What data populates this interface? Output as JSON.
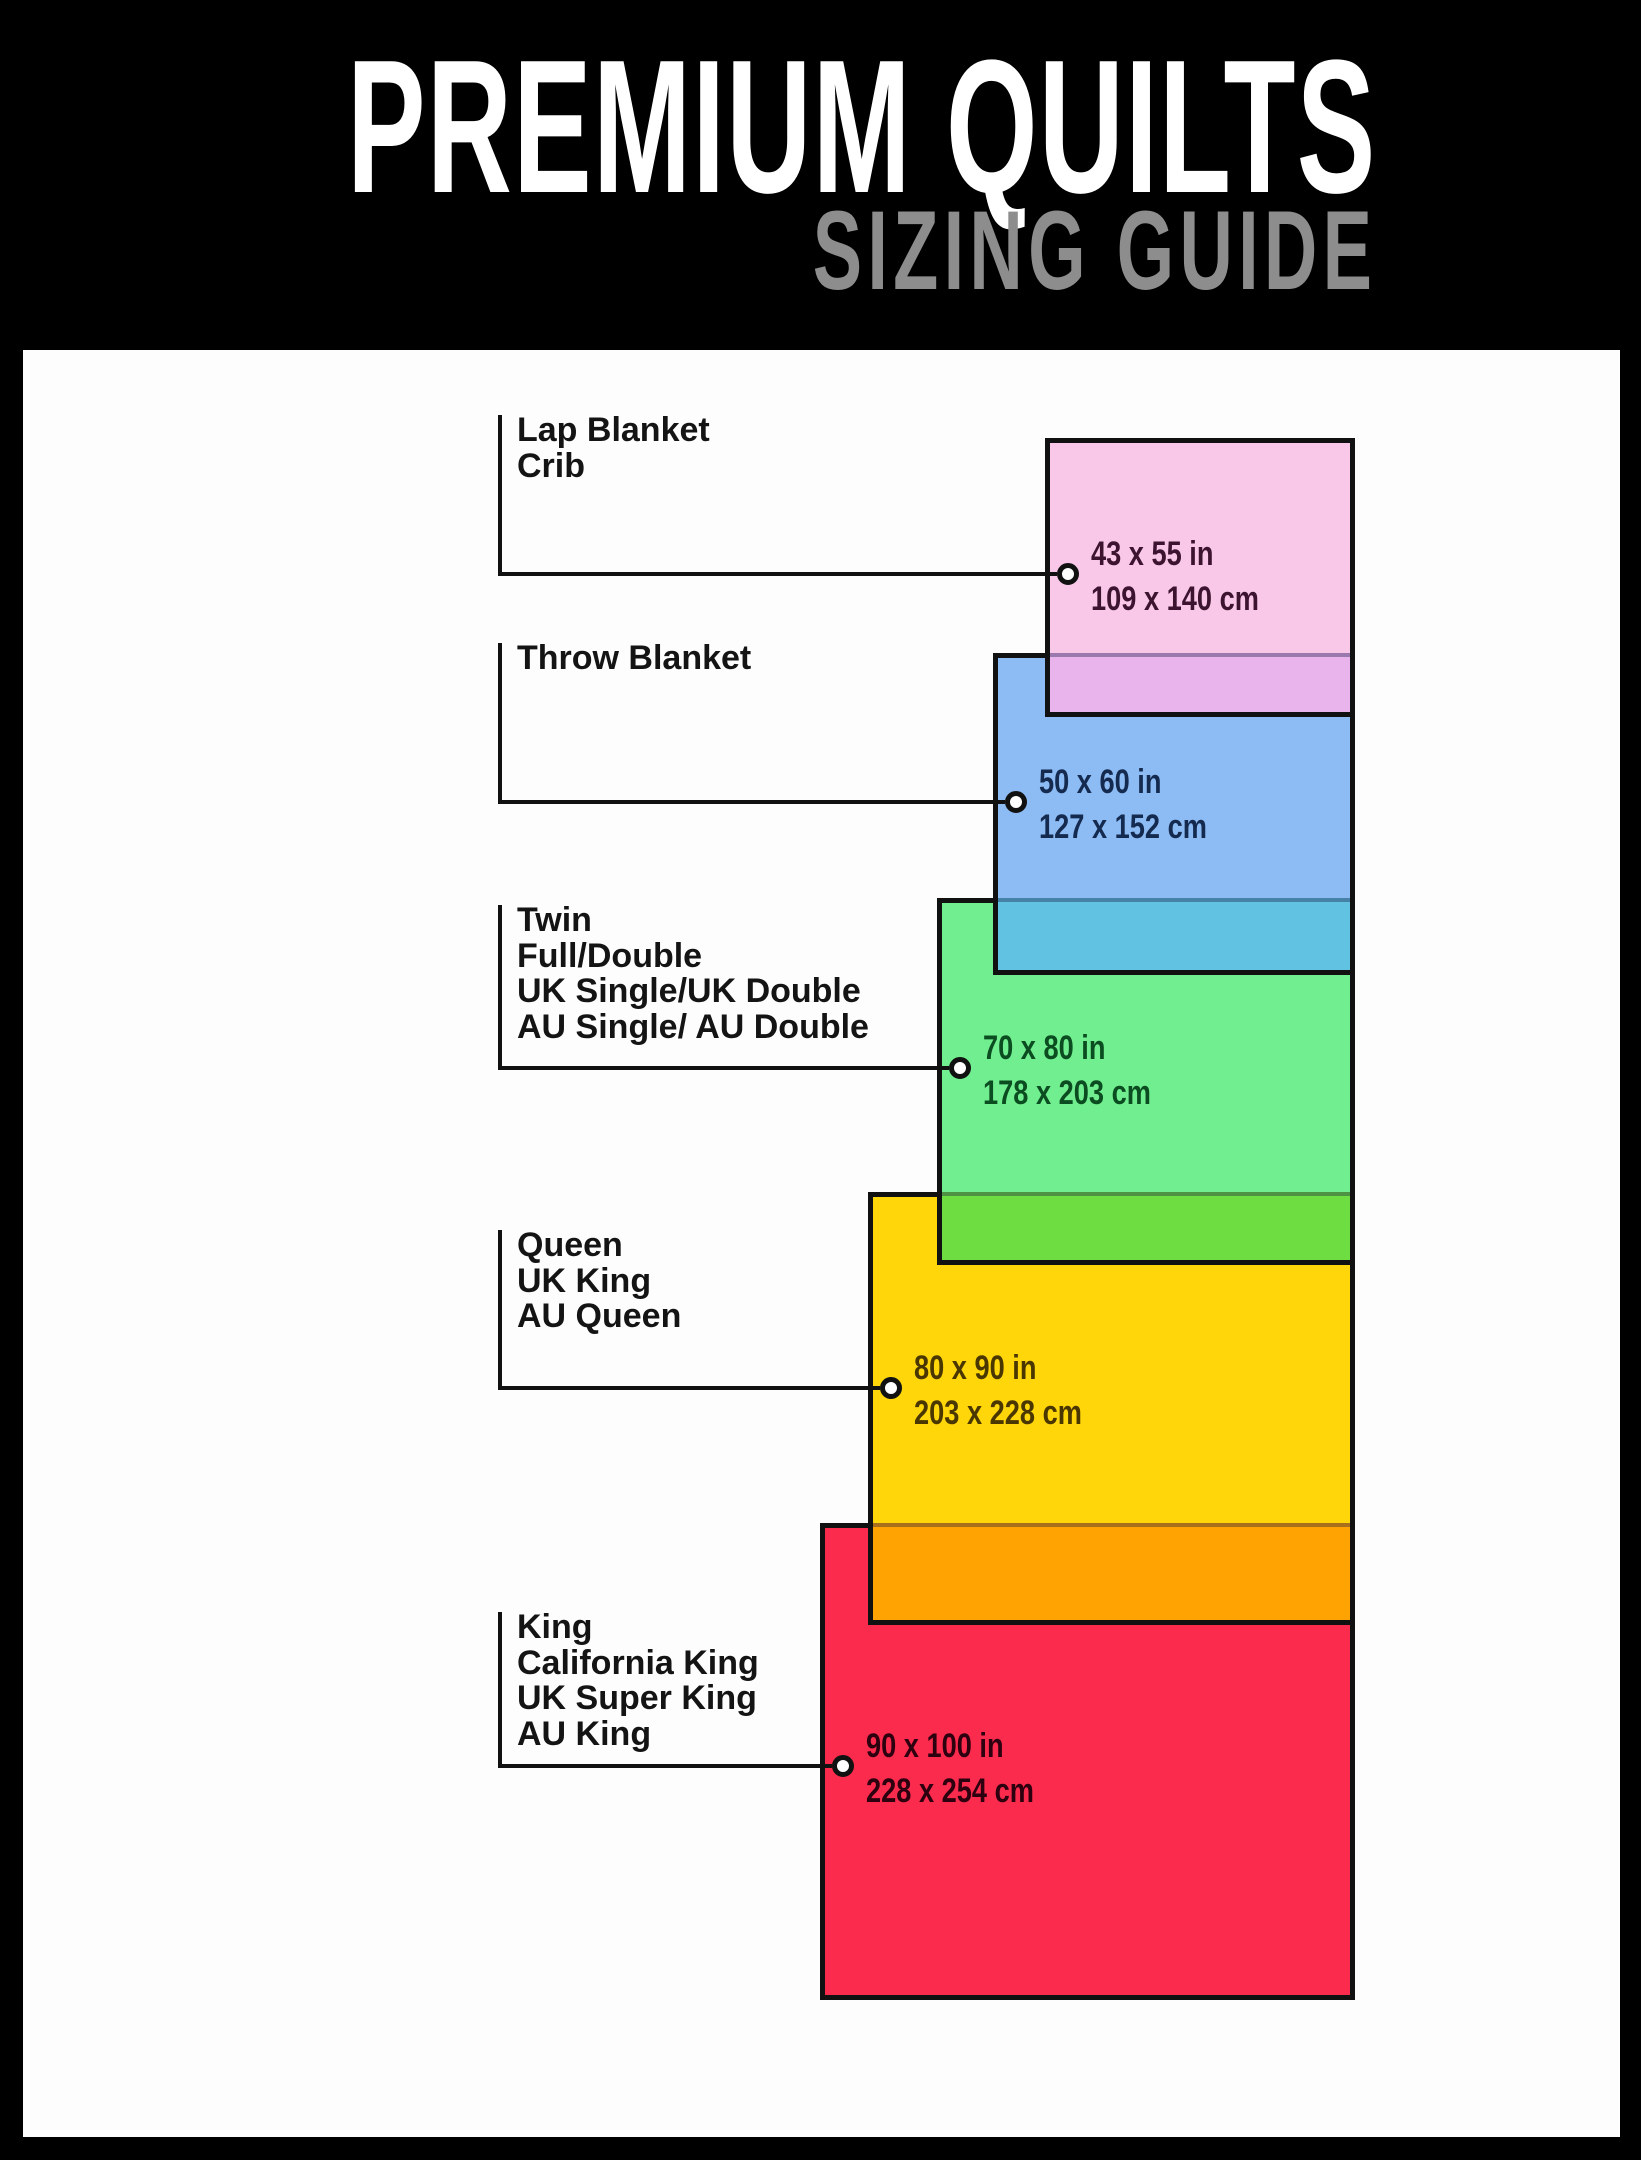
{
  "header": {
    "title": "PREMIUM QUILTS",
    "subtitle": "SIZING GUIDE",
    "title_color": "#ffffff",
    "subtitle_color": "#8d8d8d",
    "background": "#000000"
  },
  "panel": {
    "background": "#fdfdfd"
  },
  "line_ink": "#111111",
  "faint_line": "rgba(25,25,70,0.38)",
  "sizes": [
    {
      "id": "lap-blanket-crib",
      "labels": [
        "Lap Blanket",
        "Crib"
      ],
      "dim_in": "43 x 55 in",
      "dim_cm": "109 x 140 cm",
      "fill": "#f9c8e8",
      "text_color": "#3d1430",
      "overlap_color": "#e9b3ec",
      "rect": {
        "left": 1045,
        "top": 438,
        "right": 1355,
        "bottom": 717
      },
      "label_top": 415,
      "leader_y": 574
    },
    {
      "id": "throw-blanket",
      "labels": [
        "Throw Blanket"
      ],
      "dim_in": "50 x 60 in",
      "dim_cm": "127 x 152 cm",
      "fill": "#8dbbf3",
      "text_color": "#142a4f",
      "overlap_color": "#62c2e2",
      "rect": {
        "left": 993,
        "top": 653,
        "right": 1355,
        "bottom": 975
      },
      "label_top": 643,
      "leader_y": 802
    },
    {
      "id": "twin-full-double",
      "labels": [
        "Twin",
        "Full/Double",
        "UK Single/UK Double",
        "AU Single/ AU Double"
      ],
      "dim_in": "70 x 80 in",
      "dim_cm": "178 x 203 cm",
      "fill": "#71ef90",
      "text_color": "#0b4d20",
      "overlap_color": "#6edd41",
      "rect": {
        "left": 937,
        "top": 898,
        "right": 1355,
        "bottom": 1265
      },
      "label_top": 905,
      "leader_y": 1068
    },
    {
      "id": "queen-uk-king-au-queen",
      "labels": [
        "Queen",
        "UK King",
        "AU Queen"
      ],
      "dim_in": "80 x 90 in",
      "dim_cm": "203 x 228 cm",
      "fill": "#ffd60a",
      "text_color": "#4a3700",
      "overlap_color": "#ffa302",
      "rect": {
        "left": 868,
        "top": 1192,
        "right": 1355,
        "bottom": 1625
      },
      "label_top": 1230,
      "leader_y": 1388
    },
    {
      "id": "king-california-king",
      "labels": [
        "King",
        "California King",
        "UK Super King",
        "AU King"
      ],
      "dim_in": "90 x 100 in",
      "dim_cm": "228 x 254 cm",
      "fill": "#fb2b4d",
      "text_color": "#2d0010",
      "overlap_color": null,
      "rect": {
        "left": 820,
        "top": 1523,
        "right": 1355,
        "bottom": 2000
      },
      "label_top": 1612,
      "leader_y": 1766
    }
  ],
  "layout_note_values": {
    "label_line_x": 498,
    "label_text_x": 517,
    "circle_offset": 23
  }
}
